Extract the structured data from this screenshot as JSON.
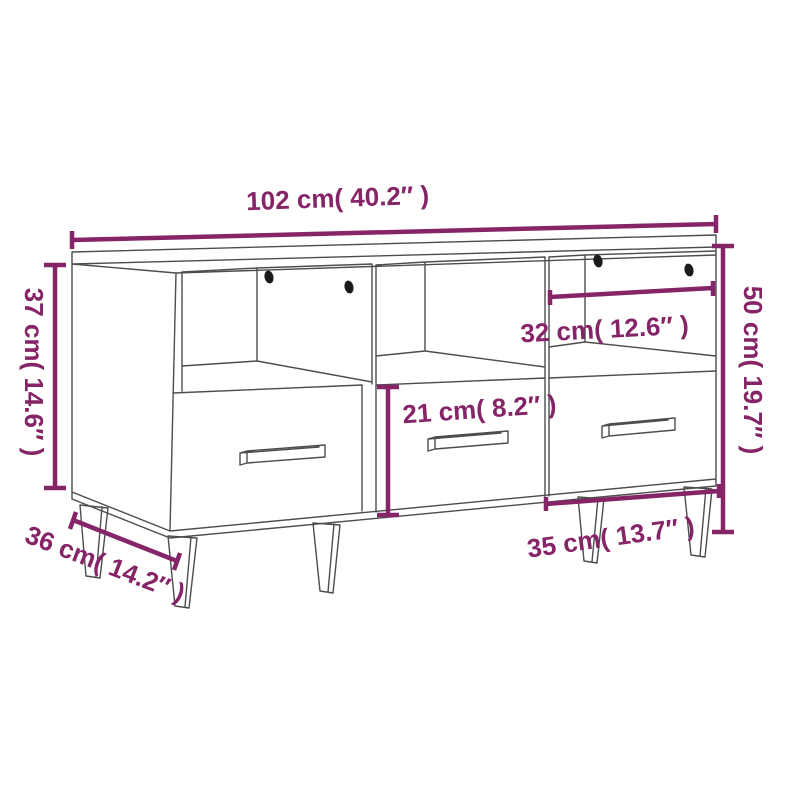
{
  "page": {
    "background": "#ffffff"
  },
  "colors": {
    "dimension_accent": "#862468",
    "drawing_line": "#4d4d4d",
    "cable_hole": "#1a1a1a"
  },
  "diagram": {
    "subject": "TV cabinet line drawing with three open compartments, three drawers and tapered legs",
    "dimensions": {
      "overall_width": {
        "label": "102 cm( 40.2″ )"
      },
      "upper_section_height": {
        "label": "37 cm( 14.6″ )"
      },
      "overall_height": {
        "label": "50 cm( 19.7″ )"
      },
      "compartment_width": {
        "label": "32 cm( 12.6″ )"
      },
      "drawer_front_height": {
        "label": "21 cm( 8.2″ )"
      },
      "drawer_width": {
        "label": "35 cm( 13.7″ )"
      },
      "overall_depth": {
        "label": "36 cm( 14.2″ )"
      }
    }
  }
}
